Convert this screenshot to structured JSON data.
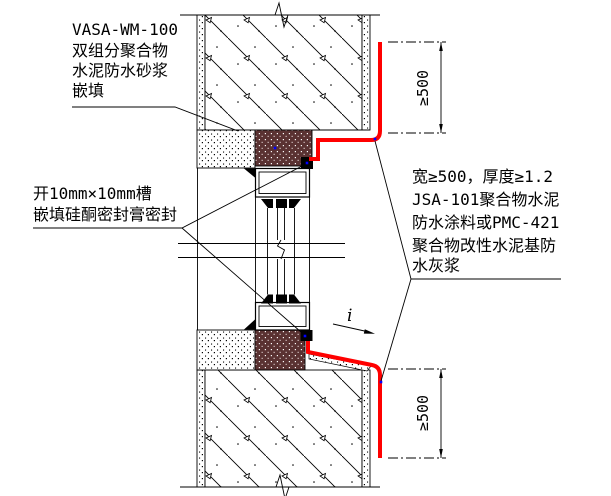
{
  "annotations": {
    "head_joint_note": {
      "lines": [
        "VASA-WM-100",
        "双组分聚合物",
        "水泥防水砂浆",
        "嵌填"
      ]
    },
    "groove_note": {
      "lines": [
        "开10mm×10mm槽",
        "嵌填硅酮密封膏密封"
      ]
    },
    "coating_note": {
      "lines": [
        "宽≥500，厚度≥1.2",
        "JSA-101聚合物水泥",
        "防水涂料或PMC-421",
        "聚合物改性水泥基防",
        "水灰浆"
      ]
    },
    "dimensions": {
      "top": "≥500",
      "bottom": "≥500"
    },
    "slope_label": "i"
  },
  "colors": {
    "waterproof_coating_line": "#ff0000",
    "sealant_fill": "#5a3232",
    "node_marker": "#0000ff",
    "line": "#000000",
    "background": "#ffffff"
  }
}
